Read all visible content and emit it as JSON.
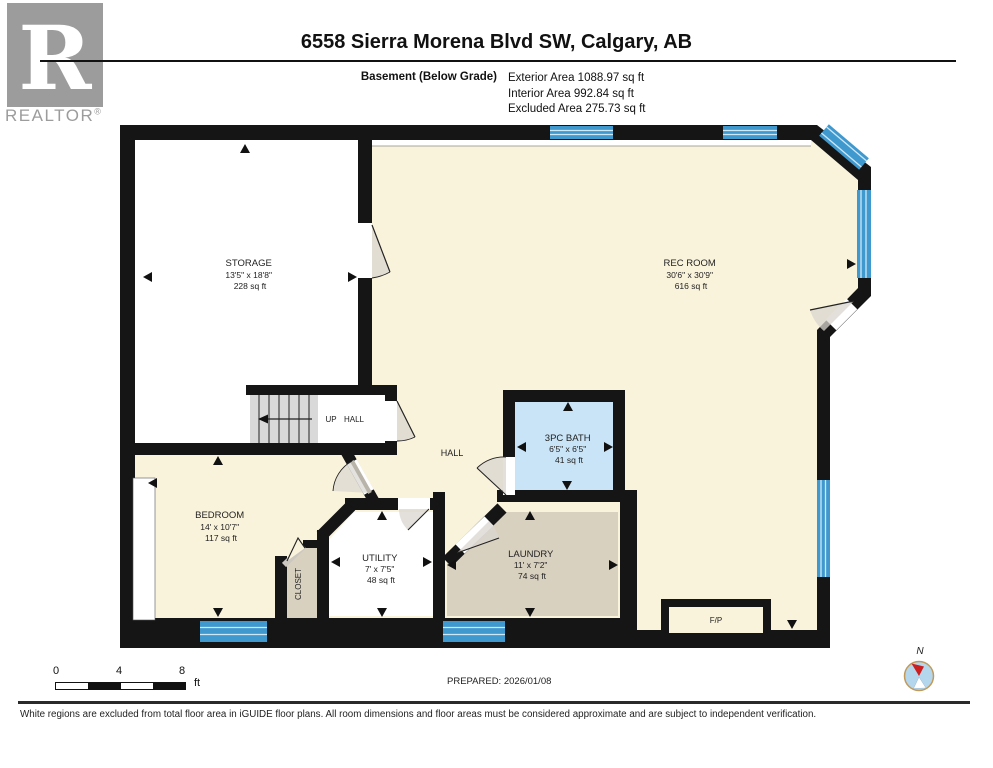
{
  "header": {
    "logo": {
      "letter": "R",
      "wordmark": "REALTOR",
      "registered": "®"
    },
    "title": "6558 Sierra Morena Blvd SW, Calgary, AB",
    "floor_label": "Basement (Below Grade)",
    "area_lines": [
      "Exterior Area 1088.97 sq ft",
      "Interior Area 992.84 sq ft",
      "Excluded Area 275.73 sq ft"
    ]
  },
  "floorplan": {
    "rooms": [
      {
        "name": "STORAGE",
        "dims": "13'5\" x 18'8\"",
        "area": "228 sq ft"
      },
      {
        "name": "REC ROOM",
        "dims": "30'6\" x 30'9\"",
        "area": "616 sq ft"
      },
      {
        "name": "BEDROOM",
        "dims": "14' x 10'7\"",
        "area": "117 sq ft"
      },
      {
        "name": "UTILITY",
        "dims": "7' x 7'5\"",
        "area": "48 sq ft"
      },
      {
        "name": "LAUNDRY",
        "dims": "11' x 7'2\"",
        "area": "74 sq ft"
      },
      {
        "name": "3PC BATH",
        "dims": "6'5\" x 6'5\"",
        "area": "41 sq ft"
      }
    ],
    "labels": {
      "hall": "HALL",
      "up": "UP",
      "stair_hall": "HALL",
      "closet": "CLOSET",
      "fireplace": "F/P"
    }
  },
  "footer": {
    "scale_ticks": [
      "0",
      "4",
      "8"
    ],
    "scale_unit": "ft",
    "prepared": "PREPARED: 2026/01/08",
    "compass": "N",
    "disclaimer": "White regions are excluded from total floor area in iGUIDE floor plans. All room dimensions and floor areas must be considered approximate and are subject to independent verification."
  },
  "colors": {
    "wall": "#151515",
    "interior_cream": "#faf3dc",
    "excluded_white": "#ffffff",
    "tan": "#d9d1c0",
    "bath_blue": "#c9e4f6",
    "window_blue": "#4099ce",
    "window_stripe": "#cfe8f7",
    "stair_gray": "#d9d9d9",
    "logo_gray": "#9c9c9c",
    "compass_ring": "#c19a5b",
    "compass_fill": "#b5d7ee",
    "needle_red": "#cc1f1f"
  }
}
